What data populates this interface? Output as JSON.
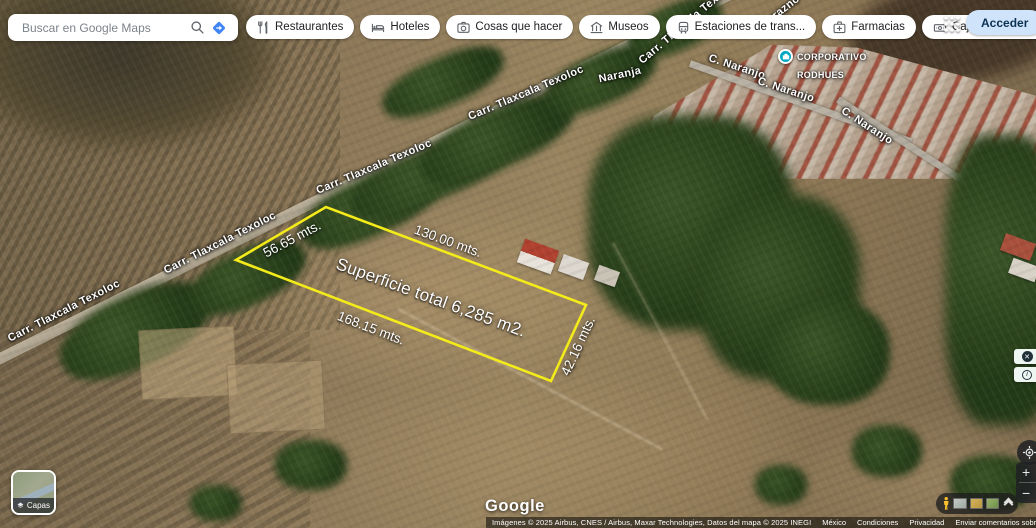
{
  "header": {
    "search": {
      "placeholder": "Buscar en Google Maps"
    },
    "signin_label": "Acceder",
    "chips": [
      {
        "label": "Restaurantes"
      },
      {
        "label": "Hoteles"
      },
      {
        "label": "Cosas que hacer"
      },
      {
        "label": "Museos"
      },
      {
        "label": "Estaciones de trans..."
      },
      {
        "label": "Farmacias"
      },
      {
        "label": "Cajeros automáticos"
      }
    ]
  },
  "map": {
    "poi": {
      "line1": "CORPORATIVO",
      "line2": "RODHUES",
      "icon_color": "#00a7c4"
    },
    "roads": {
      "carretera": "Carr. Tlaxcala Texoloc",
      "durazno": "Durazno",
      "naranja": "Naranja",
      "c_naranjo": "C. Naranjo"
    },
    "parcel": {
      "outline_color": "#f4eb1a",
      "side_top_left": "56.65 mts.",
      "side_top": "130.00 mts.",
      "side_bottom": "168.15 mts.",
      "side_right": "42.16 mts.",
      "area": "Superficie total 6,285 m2."
    }
  },
  "controls": {
    "layers_label": "Capas",
    "zoom_in": "+",
    "zoom_out": "−",
    "close_overlay": "✕",
    "info_overlay": "i"
  },
  "footer": {
    "logo": "Google",
    "credits": "Imágenes © 2025 Airbus, CNES / Airbus, Maxar Technologies, Datos del mapa © 2025 INEGI",
    "links": [
      {
        "label": "México"
      },
      {
        "label": "Condiciones"
      },
      {
        "label": "Privacidad"
      },
      {
        "label": "Enviar comentarios sobre el producto"
      }
    ],
    "scale": "20 m"
  }
}
